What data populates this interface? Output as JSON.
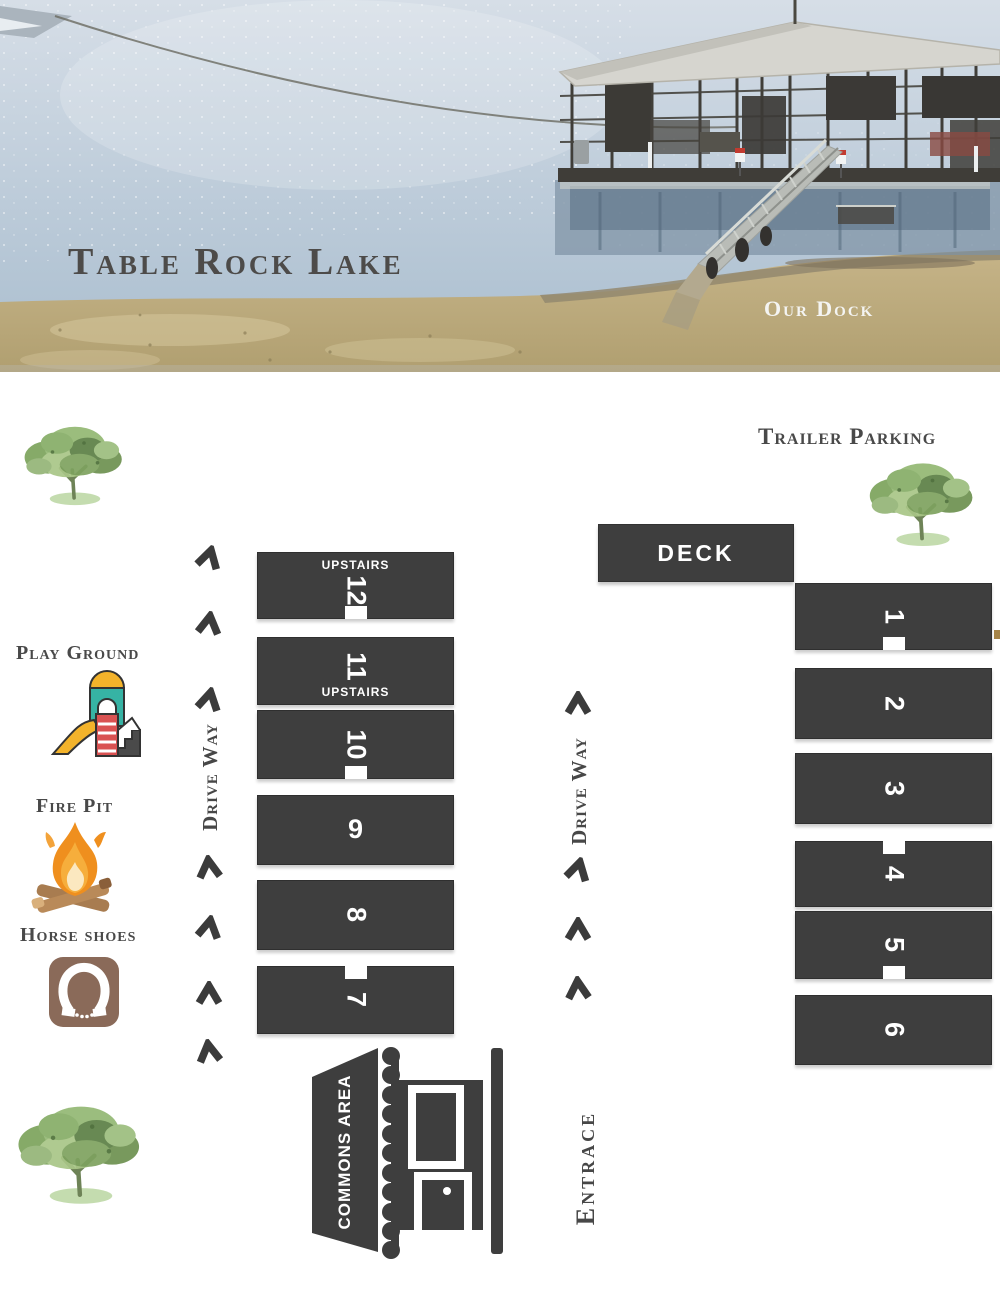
{
  "hero": {
    "title": "Table Rock Lake",
    "caption": "Our Dock"
  },
  "map": {
    "trailer_parking_label": "Trailer Parking",
    "deck_label": "DECK",
    "upstairs_label": "UPSTAIRS",
    "drive_way_left_label": "Drive Way",
    "drive_way_right_label": "Drive Way",
    "entrance_label": "Entrace",
    "play_ground_label": "Play Ground",
    "fire_pit_label": "Fire Pit",
    "horse_shoes_label": "Horse shoes",
    "commons_area_label": "Commons Area",
    "cabins_left": [
      {
        "number": "12",
        "upstairs": true,
        "door": "bottom"
      },
      {
        "number": "11",
        "upstairs": true,
        "door": null
      },
      {
        "number": "10",
        "upstairs": false,
        "door": "bottom"
      },
      {
        "number": "9",
        "upstairs": false,
        "door": null
      },
      {
        "number": "8",
        "upstairs": false,
        "door": null
      },
      {
        "number": "7",
        "upstairs": false,
        "door": "top"
      }
    ],
    "cabins_right": [
      {
        "number": "1",
        "door": "bottom"
      },
      {
        "number": "2",
        "door": null
      },
      {
        "number": "3",
        "door": null
      },
      {
        "number": "4",
        "door": "top"
      },
      {
        "number": "5",
        "door": "bottom"
      },
      {
        "number": "6",
        "door": null
      }
    ]
  },
  "icons": [
    "tree-icon",
    "playground-icon",
    "campfire-icon",
    "horseshoe-icon",
    "cabin-icon",
    "driveway-arrow-icon"
  ],
  "colors": {
    "building_dark": "#3e3e3e",
    "label_gray": "#494949",
    "water_blue": "#bccbd9",
    "grass_tan": "#bcab7d",
    "tree_green": "#93b873",
    "horseshoe_brown": "#8a6a59",
    "flame_orange": "#ef8f1e",
    "white": "#ffffff"
  }
}
